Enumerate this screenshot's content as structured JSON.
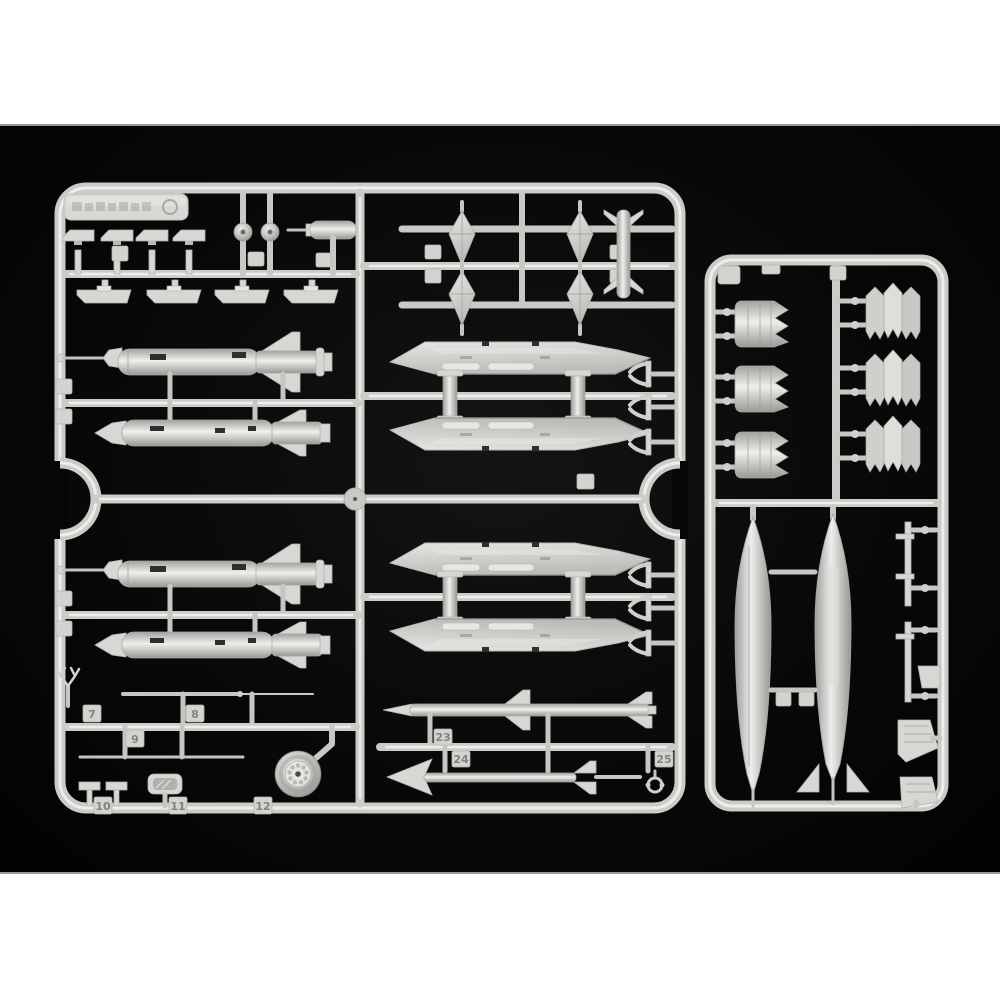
{
  "image": {
    "type": "product photo",
    "subject": "light-gray injection-molded plastic model kit sprues with aircraft weapons, drop tanks, pylons, wheels and nozzle parts on a black background",
    "background_color": "#ffffff",
    "photo_background_color": "#060606",
    "plastic_color": "#d6d6d3"
  },
  "brand_plate": {
    "description": "embossed manufacturer logo plate, text illegible"
  },
  "part_numbers": {
    "t7": "7",
    "t8": "8",
    "t9": "9",
    "t10": "10",
    "t11": "11",
    "t12": "12",
    "t23": "23",
    "t24": "24",
    "t25": "25"
  }
}
